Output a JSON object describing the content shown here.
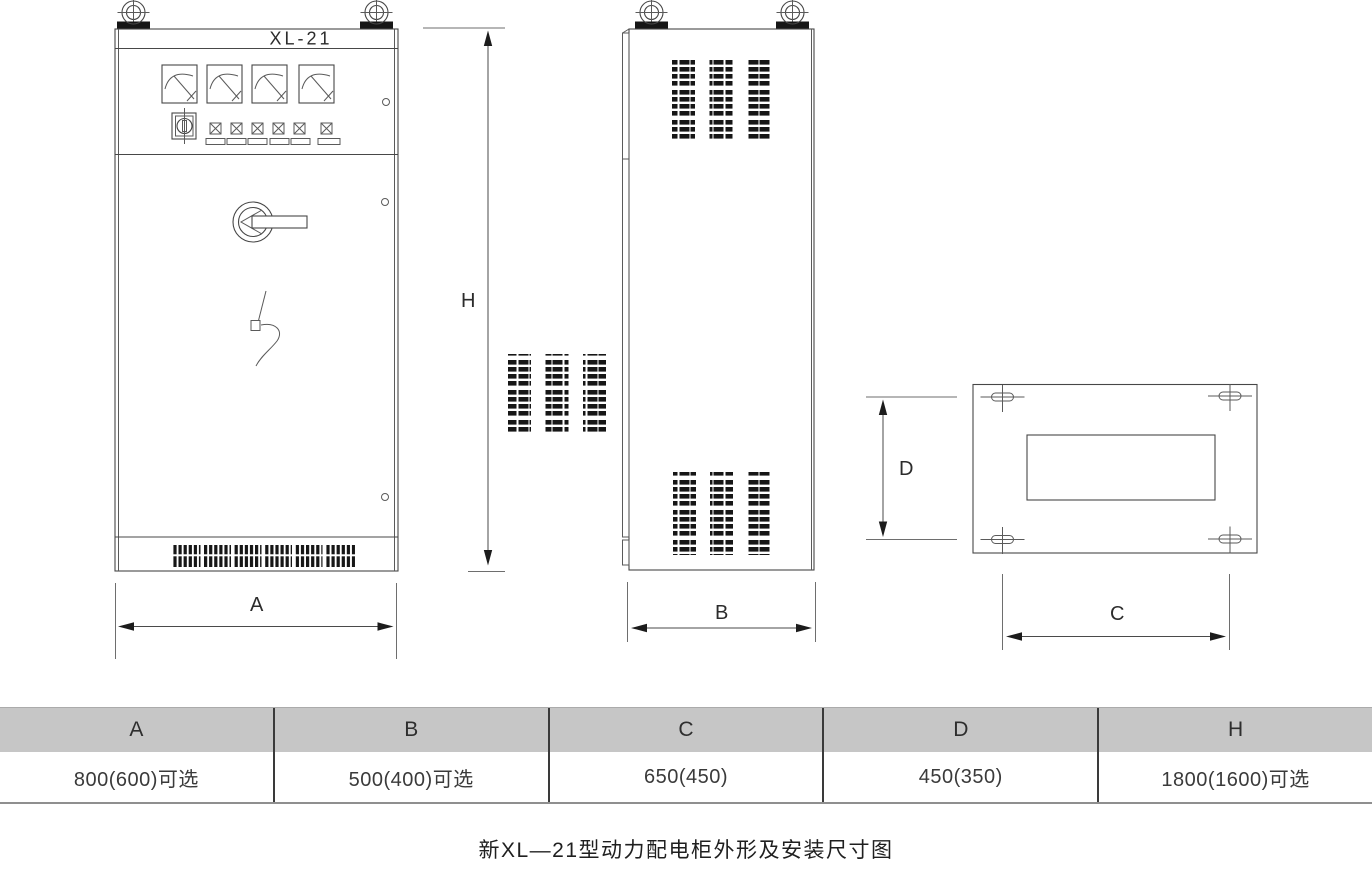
{
  "drawing": {
    "front_view": {
      "label": "XL-21"
    },
    "dimension_labels": {
      "width": "A",
      "depth": "B",
      "install_width": "C",
      "install_depth": "D",
      "height": "H"
    }
  },
  "table": {
    "headers": [
      "A",
      "B",
      "C",
      "D",
      "H"
    ],
    "values": [
      "800(600)可选",
      "500(400)可选",
      "650(450)",
      "450(350)",
      "1800(1600)可选"
    ]
  },
  "caption": "新XL—21型动力配电柜外形及安装尺寸图",
  "colors": {
    "line": "#474747",
    "dark_fill": "#161616",
    "table_header_bg": "#c6c6c6",
    "table_divider": "#3a3a3a"
  }
}
